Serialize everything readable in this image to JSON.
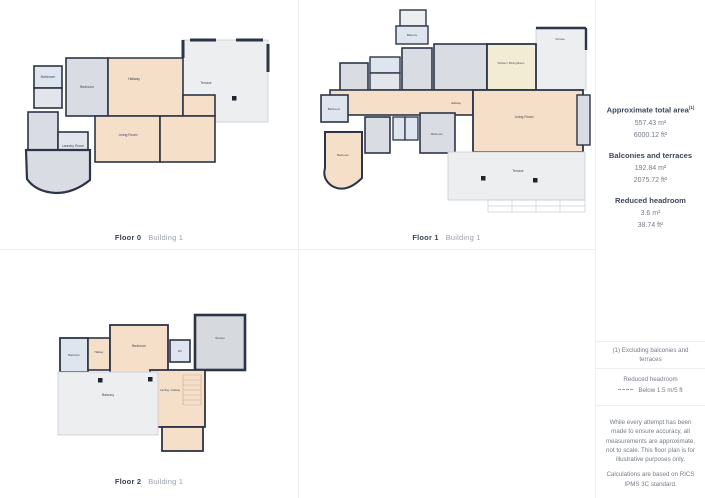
{
  "floors": [
    {
      "label": "Floor 0",
      "building": "Building 1",
      "rooms": {
        "terrace": "Terrace",
        "bathroom": "Bathroom",
        "bedroom": "Bedroom",
        "hallway": "Hallway",
        "living_room": "Living Room",
        "laundry": "Laundry Room"
      }
    },
    {
      "label": "Floor 1",
      "building": "Building 1",
      "rooms": {
        "balcony": "Balcony",
        "terrace_top": "Terrace",
        "kitchen": "Kitchen / Dining Room",
        "living_room": "Living Room",
        "hallway": "Hallway",
        "bathroom": "Bathroom",
        "bedroom_left": "Bedroom",
        "bedroom_mid": "Bedroom",
        "terrace_main": "Terrace"
      }
    },
    {
      "label": "Floor 2",
      "building": "Building 1",
      "rooms": {
        "bathroom": "Bathroom",
        "hallway": "Hallway",
        "bedroom": "Bedroom",
        "wc": "WC",
        "landing": "Landing / Hallway",
        "balcony": "Balcony",
        "terrace": "Terrace"
      }
    }
  ],
  "sidebar": {
    "total": {
      "title": "Approximate total area",
      "sup": "(1)",
      "m2": "557.43 m²",
      "ft2": "6000.12 ft²"
    },
    "balconies": {
      "title": "Balconies and terraces",
      "m2": "192.84 m²",
      "ft2": "2075.72 ft²"
    },
    "headroom": {
      "title": "Reduced headroom",
      "m2": "3.6 m²",
      "ft2": "38.74 ft²"
    },
    "exclusion_note": "(1) Excluding balconies and terraces",
    "legend": {
      "title": "Reduced headroom",
      "line_label": "Below 1.5 m/5 ft"
    },
    "disclaimer": "While every attempt has been made to ensure accuracy, all measurements are approximate, not to scale. This floor plan is for illustrative purposes only.",
    "standard_note": "Calculations are based on RICS IPMS 3C standard.",
    "brand": {
      "name": "GIRAFFE",
      "suffix": "360"
    }
  },
  "colors": {
    "wall": "#2c3547",
    "room_peach": "#f6dfc9",
    "room_cream": "#f2ecd4",
    "room_gray": "#d9dde3",
    "room_blue": "#dfe5ee",
    "terrace_gray": "#eceef0",
    "divider": "#f0f0f1",
    "text_dark": "#3d4659",
    "text_gray": "#767c89"
  }
}
